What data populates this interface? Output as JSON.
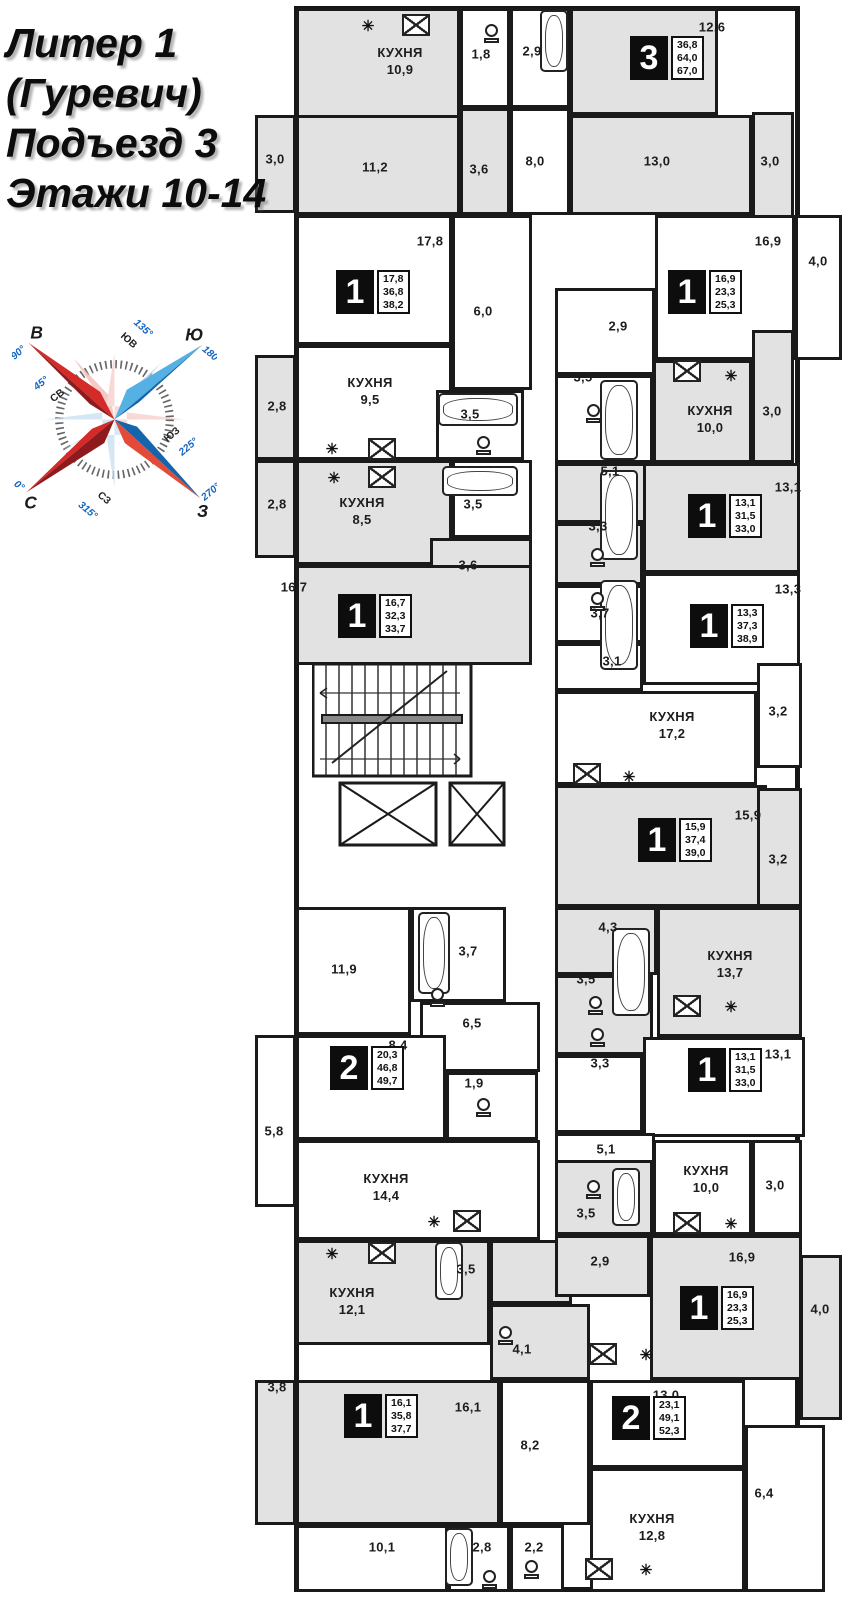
{
  "title": {
    "line1": "Литер 1",
    "line2": "(Гуревич)",
    "line3": "Подъезд 3",
    "line4": "Этажи 10-14"
  },
  "compass": {
    "e": "В",
    "e_deg": "90°",
    "s": "Ю",
    "s_deg": "180°",
    "n": "С",
    "n_deg": "0°",
    "w": "З",
    "w_deg": "270°",
    "ne": "СВ",
    "ne_deg": "45°",
    "se": "ЮВ",
    "se_deg": "135°",
    "sw": "ЮЗ",
    "sw_deg": "225°",
    "nw": "СЗ",
    "nw_deg": "315°"
  },
  "colors": {
    "shade": "#e2e2e2",
    "wall": "#1a1a1a",
    "badge_bg": "#0d0d0d",
    "compass_red": "#d42a28",
    "compass_dark_red": "#8f1a1d",
    "compass_blue": "#1565ac",
    "compass_light_blue": "#55b0e4"
  },
  "plan": {
    "kitchen_word": "КУХНЯ",
    "rooms": [
      {
        "x": 296,
        "y": 8,
        "w": 164,
        "h": 207,
        "s": 1
      },
      {
        "x": 460,
        "y": 8,
        "w": 50,
        "h": 100,
        "s": 0
      },
      {
        "x": 510,
        "y": 8,
        "w": 60,
        "h": 100,
        "s": 0
      },
      {
        "x": 570,
        "y": 8,
        "w": 148,
        "h": 107,
        "s": 1
      },
      {
        "x": 570,
        "y": 115,
        "w": 182,
        "h": 100,
        "s": 1
      },
      {
        "x": 752,
        "y": 112,
        "w": 42,
        "h": 178,
        "s": 1
      },
      {
        "x": 255,
        "y": 115,
        "w": 41,
        "h": 98,
        "s": 1
      },
      {
        "x": 296,
        "y": 115,
        "w": 164,
        "h": 100,
        "s": 1
      },
      {
        "x": 460,
        "y": 108,
        "w": 50,
        "h": 107,
        "s": 1
      },
      {
        "x": 510,
        "y": 108,
        "w": 60,
        "h": 107,
        "s": 0
      },
      {
        "x": 296,
        "y": 215,
        "w": 156,
        "h": 130,
        "s": 0
      },
      {
        "x": 452,
        "y": 215,
        "w": 80,
        "h": 175,
        "s": 0
      },
      {
        "x": 296,
        "y": 345,
        "w": 156,
        "h": 115,
        "s": 0
      },
      {
        "x": 436,
        "y": 390,
        "w": 88,
        "h": 70,
        "s": 0
      },
      {
        "x": 255,
        "y": 355,
        "w": 41,
        "h": 105,
        "s": 1
      },
      {
        "x": 655,
        "y": 215,
        "w": 140,
        "h": 145,
        "s": 0
      },
      {
        "x": 795,
        "y": 215,
        "w": 47,
        "h": 145,
        "s": 0
      },
      {
        "x": 555,
        "y": 288,
        "w": 100,
        "h": 87,
        "s": 0
      },
      {
        "x": 555,
        "y": 375,
        "w": 98,
        "h": 88,
        "s": 0
      },
      {
        "x": 653,
        "y": 360,
        "w": 99,
        "h": 103,
        "s": 1
      },
      {
        "x": 752,
        "y": 330,
        "w": 42,
        "h": 133,
        "s": 1
      },
      {
        "x": 296,
        "y": 460,
        "w": 156,
        "h": 105,
        "s": 1
      },
      {
        "x": 452,
        "y": 460,
        "w": 80,
        "h": 78,
        "s": 0
      },
      {
        "x": 430,
        "y": 538,
        "w": 102,
        "h": 62,
        "s": 1
      },
      {
        "x": 255,
        "y": 460,
        "w": 41,
        "h": 98,
        "s": 1
      },
      {
        "x": 296,
        "y": 565,
        "w": 236,
        "h": 100,
        "s": 1
      },
      {
        "x": 555,
        "y": 463,
        "w": 100,
        "h": 60,
        "s": 1
      },
      {
        "x": 555,
        "y": 523,
        "w": 88,
        "h": 62,
        "s": 1
      },
      {
        "x": 643,
        "y": 463,
        "w": 157,
        "h": 110,
        "s": 1
      },
      {
        "x": 555,
        "y": 585,
        "w": 88,
        "h": 58,
        "s": 0
      },
      {
        "x": 643,
        "y": 573,
        "w": 157,
        "h": 112,
        "s": 0
      },
      {
        "x": 555,
        "y": 643,
        "w": 88,
        "h": 48,
        "s": 0
      },
      {
        "x": 555,
        "y": 691,
        "w": 202,
        "h": 94,
        "s": 0
      },
      {
        "x": 757,
        "y": 663,
        "w": 45,
        "h": 105,
        "s": 0
      },
      {
        "x": 555,
        "y": 785,
        "w": 212,
        "h": 122,
        "s": 1
      },
      {
        "x": 757,
        "y": 788,
        "w": 45,
        "h": 119,
        "s": 1
      },
      {
        "x": 296,
        "y": 907,
        "w": 115,
        "h": 128,
        "s": 0
      },
      {
        "x": 411,
        "y": 907,
        "w": 95,
        "h": 95,
        "s": 0
      },
      {
        "x": 420,
        "y": 1002,
        "w": 120,
        "h": 70,
        "s": 0
      },
      {
        "x": 296,
        "y": 1035,
        "w": 150,
        "h": 105,
        "s": 0
      },
      {
        "x": 446,
        "y": 1072,
        "w": 92,
        "h": 68,
        "s": 0
      },
      {
        "x": 255,
        "y": 1035,
        "w": 41,
        "h": 172,
        "s": 0
      },
      {
        "x": 555,
        "y": 907,
        "w": 102,
        "h": 68,
        "s": 1
      },
      {
        "x": 555,
        "y": 975,
        "w": 98,
        "h": 80,
        "s": 1
      },
      {
        "x": 657,
        "y": 907,
        "w": 145,
        "h": 130,
        "s": 1
      },
      {
        "x": 555,
        "y": 1055,
        "w": 88,
        "h": 78,
        "s": 0
      },
      {
        "x": 643,
        "y": 1037,
        "w": 162,
        "h": 100,
        "s": 0
      },
      {
        "x": 555,
        "y": 1133,
        "w": 100,
        "h": 72,
        "s": 0
      },
      {
        "x": 296,
        "y": 1140,
        "w": 244,
        "h": 100,
        "s": 0
      },
      {
        "x": 296,
        "y": 1240,
        "w": 194,
        "h": 105,
        "s": 1
      },
      {
        "x": 490,
        "y": 1240,
        "w": 82,
        "h": 64,
        "s": 1
      },
      {
        "x": 490,
        "y": 1304,
        "w": 100,
        "h": 76,
        "s": 1
      },
      {
        "x": 555,
        "y": 1160,
        "w": 98,
        "h": 75,
        "s": 1
      },
      {
        "x": 653,
        "y": 1140,
        "w": 99,
        "h": 95,
        "s": 0
      },
      {
        "x": 752,
        "y": 1140,
        "w": 50,
        "h": 95,
        "s": 0
      },
      {
        "x": 555,
        "y": 1235,
        "w": 95,
        "h": 62,
        "s": 1
      },
      {
        "x": 650,
        "y": 1235,
        "w": 152,
        "h": 145,
        "s": 1
      },
      {
        "x": 800,
        "y": 1255,
        "w": 42,
        "h": 165,
        "s": 1
      },
      {
        "x": 296,
        "y": 1380,
        "w": 204,
        "h": 145,
        "s": 1
      },
      {
        "x": 255,
        "y": 1380,
        "w": 41,
        "h": 145,
        "s": 1
      },
      {
        "x": 296,
        "y": 1525,
        "w": 152,
        "h": 67,
        "s": 0
      },
      {
        "x": 448,
        "y": 1525,
        "w": 62,
        "h": 67,
        "s": 0
      },
      {
        "x": 510,
        "y": 1525,
        "w": 54,
        "h": 67,
        "s": 0
      },
      {
        "x": 500,
        "y": 1380,
        "w": 90,
        "h": 145,
        "s": 0
      },
      {
        "x": 590,
        "y": 1380,
        "w": 155,
        "h": 88,
        "s": 0
      },
      {
        "x": 590,
        "y": 1468,
        "w": 155,
        "h": 124,
        "s": 0
      },
      {
        "x": 745,
        "y": 1425,
        "w": 80,
        "h": 167,
        "s": 0
      }
    ],
    "labels": [
      {
        "t": "КУХНЯ\n10,9",
        "x": 400,
        "y": 62
      },
      {
        "t": "1,8",
        "x": 481,
        "y": 55
      },
      {
        "t": "2,9",
        "x": 532,
        "y": 52
      },
      {
        "t": "12,6",
        "x": 712,
        "y": 28
      },
      {
        "t": "13,0",
        "x": 657,
        "y": 162
      },
      {
        "t": "3,0",
        "x": 770,
        "y": 162
      },
      {
        "t": "3,0",
        "x": 275,
        "y": 160
      },
      {
        "t": "11,2",
        "x": 375,
        "y": 168
      },
      {
        "t": "3,6",
        "x": 479,
        "y": 170
      },
      {
        "t": "8,0",
        "x": 535,
        "y": 162
      },
      {
        "t": "17,8",
        "x": 430,
        "y": 242
      },
      {
        "t": "6,0",
        "x": 483,
        "y": 312
      },
      {
        "t": "КУХНЯ\n9,5",
        "x": 370,
        "y": 392
      },
      {
        "t": "3,5",
        "x": 470,
        "y": 415
      },
      {
        "t": "2,8",
        "x": 277,
        "y": 407
      },
      {
        "t": "16,9",
        "x": 768,
        "y": 242
      },
      {
        "t": "4,0",
        "x": 818,
        "y": 262
      },
      {
        "t": "2,9",
        "x": 618,
        "y": 327
      },
      {
        "t": "3,5",
        "x": 583,
        "y": 378
      },
      {
        "t": "КУХНЯ\n10,0",
        "x": 710,
        "y": 420
      },
      {
        "t": "3,0",
        "x": 772,
        "y": 412
      },
      {
        "t": "КУХНЯ\n8,5",
        "x": 362,
        "y": 512
      },
      {
        "t": "3,5",
        "x": 473,
        "y": 505
      },
      {
        "t": "2,8",
        "x": 277,
        "y": 505
      },
      {
        "t": "3,6",
        "x": 468,
        "y": 566
      },
      {
        "t": "16,7",
        "x": 294,
        "y": 588
      },
      {
        "t": "5,1",
        "x": 610,
        "y": 472
      },
      {
        "t": "3,3",
        "x": 598,
        "y": 527
      },
      {
        "t": "13,1",
        "x": 788,
        "y": 488
      },
      {
        "t": "3,7",
        "x": 600,
        "y": 614
      },
      {
        "t": "13,3",
        "x": 788,
        "y": 590
      },
      {
        "t": "3,1",
        "x": 612,
        "y": 662
      },
      {
        "t": "КУХНЯ\n17,2",
        "x": 672,
        "y": 726
      },
      {
        "t": "3,2",
        "x": 778,
        "y": 712
      },
      {
        "t": "15,9",
        "x": 748,
        "y": 816
      },
      {
        "t": "3,2",
        "x": 778,
        "y": 860
      },
      {
        "t": "11,9",
        "x": 344,
        "y": 970
      },
      {
        "t": "3,7",
        "x": 468,
        "y": 952
      },
      {
        "t": "6,5",
        "x": 472,
        "y": 1024
      },
      {
        "t": "8,4",
        "x": 398,
        "y": 1046
      },
      {
        "t": "1,9",
        "x": 474,
        "y": 1084
      },
      {
        "t": "5,8",
        "x": 274,
        "y": 1132
      },
      {
        "t": "4,3",
        "x": 608,
        "y": 928
      },
      {
        "t": "3,5",
        "x": 586,
        "y": 980
      },
      {
        "t": "КУХНЯ\n13,7",
        "x": 730,
        "y": 965
      },
      {
        "t": "3,3",
        "x": 600,
        "y": 1064
      },
      {
        "t": "13,1",
        "x": 778,
        "y": 1055
      },
      {
        "t": "5,1",
        "x": 606,
        "y": 1150
      },
      {
        "t": "КУХНЯ\n14,4",
        "x": 386,
        "y": 1188
      },
      {
        "t": "КУХНЯ\n12,1",
        "x": 352,
        "y": 1302
      },
      {
        "t": "3,5",
        "x": 466,
        "y": 1270
      },
      {
        "t": "4,1",
        "x": 522,
        "y": 1350
      },
      {
        "t": "3,5",
        "x": 586,
        "y": 1214
      },
      {
        "t": "КУХНЯ\n10,0",
        "x": 706,
        "y": 1180
      },
      {
        "t": "3,0",
        "x": 775,
        "y": 1186
      },
      {
        "t": "2,9",
        "x": 600,
        "y": 1262
      },
      {
        "t": "16,9",
        "x": 742,
        "y": 1258
      },
      {
        "t": "4,0",
        "x": 820,
        "y": 1310
      },
      {
        "t": "13,0",
        "x": 666,
        "y": 1396
      },
      {
        "t": "8,2",
        "x": 530,
        "y": 1446
      },
      {
        "t": "16,1",
        "x": 468,
        "y": 1408
      },
      {
        "t": "3,8",
        "x": 277,
        "y": 1388
      },
      {
        "t": "10,1",
        "x": 382,
        "y": 1548
      },
      {
        "t": "2,8",
        "x": 482,
        "y": 1548
      },
      {
        "t": "2,2",
        "x": 534,
        "y": 1548
      },
      {
        "t": "КУХНЯ\n12,8",
        "x": 652,
        "y": 1528
      },
      {
        "t": "6,4",
        "x": 764,
        "y": 1494
      }
    ],
    "apartments": [
      {
        "n": "3",
        "a": [
          "36,8",
          "64,0",
          "67,0"
        ],
        "x": 630,
        "y": 36
      },
      {
        "n": "1",
        "a": [
          "17,8",
          "36,8",
          "38,2"
        ],
        "x": 336,
        "y": 270
      },
      {
        "n": "1",
        "a": [
          "16,9",
          "23,3",
          "25,3"
        ],
        "x": 668,
        "y": 270
      },
      {
        "n": "1",
        "a": [
          "16,7",
          "32,3",
          "33,7"
        ],
        "x": 338,
        "y": 594
      },
      {
        "n": "1",
        "a": [
          "13,1",
          "31,5",
          "33,0"
        ],
        "x": 688,
        "y": 494
      },
      {
        "n": "1",
        "a": [
          "13,3",
          "37,3",
          "38,9"
        ],
        "x": 690,
        "y": 604
      },
      {
        "n": "1",
        "a": [
          "15,9",
          "37,4",
          "39,0"
        ],
        "x": 638,
        "y": 818
      },
      {
        "n": "2",
        "a": [
          "20,3",
          "46,8",
          "49,7"
        ],
        "x": 330,
        "y": 1046
      },
      {
        "n": "1",
        "a": [
          "13,1",
          "31,5",
          "33,0"
        ],
        "x": 688,
        "y": 1048
      },
      {
        "n": "1",
        "a": [
          "16,9",
          "23,3",
          "25,3"
        ],
        "x": 680,
        "y": 1286
      },
      {
        "n": "1",
        "a": [
          "16,1",
          "35,8",
          "37,7"
        ],
        "x": 344,
        "y": 1394
      },
      {
        "n": "2",
        "a": [
          "23,1",
          "49,1",
          "52,3"
        ],
        "x": 612,
        "y": 1396
      }
    ],
    "fixtures": {
      "tubs": [
        {
          "x": 540,
          "y": 10,
          "w": 28,
          "h": 62
        },
        {
          "x": 438,
          "y": 393,
          "w": 80,
          "h": 33
        },
        {
          "x": 600,
          "y": 380,
          "w": 38,
          "h": 80
        },
        {
          "x": 442,
          "y": 466,
          "w": 76,
          "h": 30
        },
        {
          "x": 600,
          "y": 470,
          "w": 38,
          "h": 90
        },
        {
          "x": 600,
          "y": 580,
          "w": 38,
          "h": 90
        },
        {
          "x": 612,
          "y": 928,
          "w": 38,
          "h": 88
        },
        {
          "x": 418,
          "y": 912,
          "w": 32,
          "h": 82
        },
        {
          "x": 435,
          "y": 1242,
          "w": 28,
          "h": 58
        },
        {
          "x": 612,
          "y": 1168,
          "w": 28,
          "h": 58
        },
        {
          "x": 445,
          "y": 1528,
          "w": 28,
          "h": 58
        }
      ],
      "toilets": [
        {
          "x": 484,
          "y": 24
        },
        {
          "x": 476,
          "y": 436
        },
        {
          "x": 586,
          "y": 404
        },
        {
          "x": 590,
          "y": 548
        },
        {
          "x": 590,
          "y": 592
        },
        {
          "x": 588,
          "y": 996
        },
        {
          "x": 476,
          "y": 1098
        },
        {
          "x": 590,
          "y": 1028
        },
        {
          "x": 498,
          "y": 1326
        },
        {
          "x": 586,
          "y": 1180
        },
        {
          "x": 524,
          "y": 1560
        },
        {
          "x": 482,
          "y": 1570
        },
        {
          "x": 430,
          "y": 988
        }
      ],
      "stoves": [
        {
          "x": 402,
          "y": 14
        },
        {
          "x": 368,
          "y": 438
        },
        {
          "x": 368,
          "y": 466
        },
        {
          "x": 673,
          "y": 360
        },
        {
          "x": 673,
          "y": 995
        },
        {
          "x": 453,
          "y": 1210
        },
        {
          "x": 368,
          "y": 1242
        },
        {
          "x": 673,
          "y": 1212
        },
        {
          "x": 585,
          "y": 1558
        },
        {
          "x": 573,
          "y": 763
        },
        {
          "x": 589,
          "y": 1343
        }
      ],
      "vents": [
        {
          "x": 368,
          "y": 26
        },
        {
          "x": 332,
          "y": 449
        },
        {
          "x": 334,
          "y": 478
        },
        {
          "x": 731,
          "y": 376
        },
        {
          "x": 629,
          "y": 777
        },
        {
          "x": 731,
          "y": 1007
        },
        {
          "x": 434,
          "y": 1222
        },
        {
          "x": 332,
          "y": 1254
        },
        {
          "x": 731,
          "y": 1224
        },
        {
          "x": 646,
          "y": 1570
        },
        {
          "x": 646,
          "y": 1355
        }
      ]
    }
  }
}
